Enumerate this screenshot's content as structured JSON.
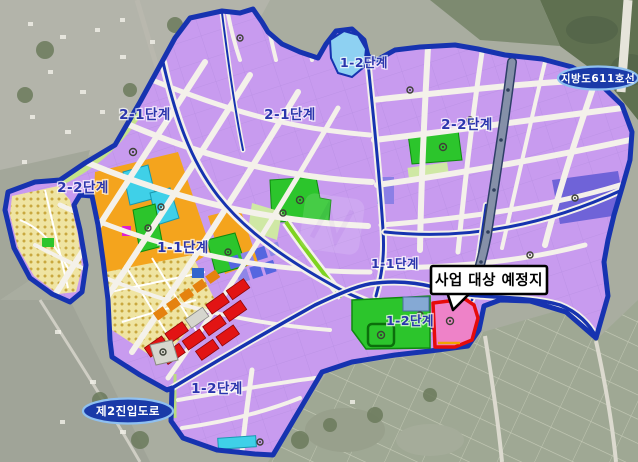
{
  "map": {
    "type": "urban-development-phase-plan-over-satellite",
    "region_labels": [
      {
        "text": "2-1단계"
      },
      {
        "text": "2-1단계"
      },
      {
        "text": "2-2단계"
      },
      {
        "text": "1-2단계"
      },
      {
        "text": "2-2단계"
      },
      {
        "text": "1-1단계"
      },
      {
        "text": "1-1단계"
      },
      {
        "text": "1-2단계"
      },
      {
        "text": "1-2단계"
      }
    ],
    "road_badges": [
      {
        "text": "지방도611호선"
      },
      {
        "text": "제2진입도로"
      }
    ],
    "callout": {
      "text": "사업 대상 예정지"
    },
    "colors": {
      "boundary_blue": "#1633b0",
      "residential_purple": "#c89bef",
      "violet_block": "#6f63d8",
      "orange_zone": "#f4a41d",
      "housing_yellow": "#efe4a2",
      "commercial_red": "#e21414",
      "park_green": "#2cc52c",
      "pale_green": "#cfe8a4",
      "school_cyan": "#3fd0e8",
      "sky_blue": "#8ed1f2",
      "site_pink": "#ee82c8",
      "site_border_red": "#e60b0b",
      "road_white": "#f4f1ea",
      "badge_fill": "#1a3aa8",
      "badge_ring": "#8fc0f0",
      "badge_text": "#ffffff",
      "label_blue": "#2b36ad",
      "satellite_gray": "#a9ada0",
      "forest_green": "#5f7050",
      "farmland_green": "#9fa894"
    }
  }
}
